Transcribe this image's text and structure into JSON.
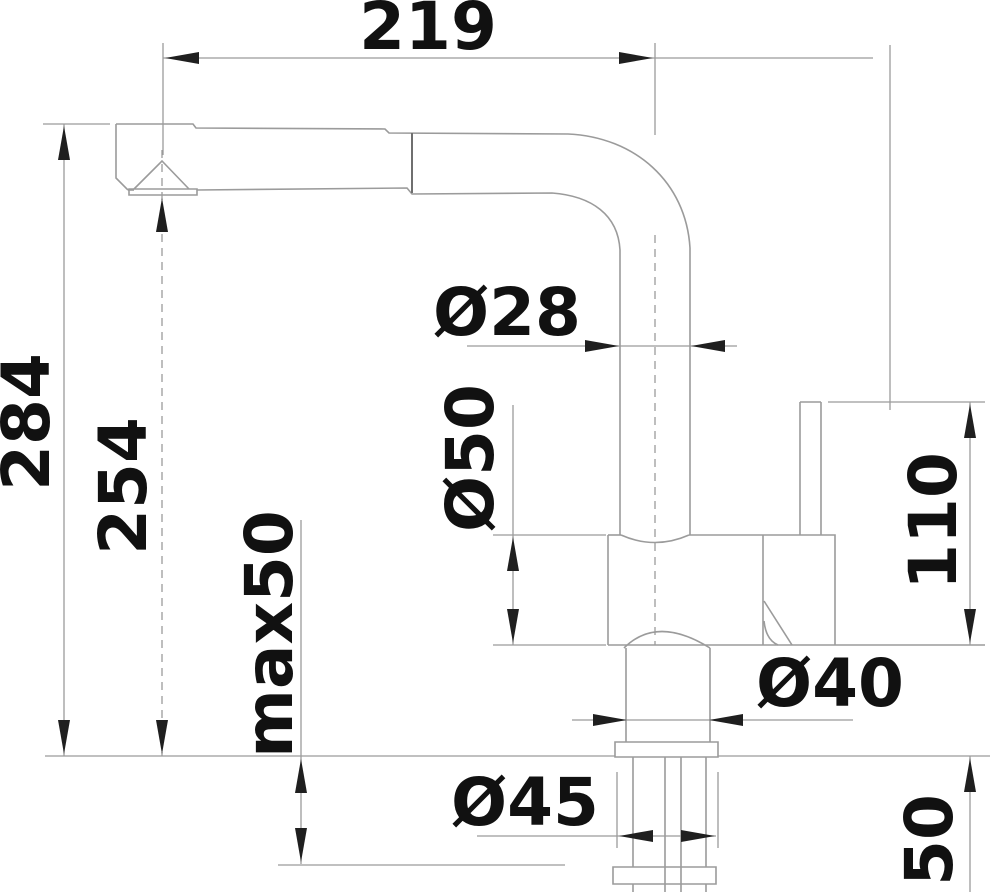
{
  "drawing": {
    "description": "faucet dimensional drawing",
    "colors": {
      "line": "#9b9b9b",
      "arrow": "#1f1f1f",
      "text": "#111111",
      "background": "#ffffff"
    },
    "dimensions": [
      {
        "id": "spout-reach",
        "label": "219",
        "orientation": "horizontal"
      },
      {
        "id": "total-height",
        "label": "284",
        "orientation": "vertical"
      },
      {
        "id": "spout-height",
        "label": "254",
        "orientation": "vertical"
      },
      {
        "id": "max-mount-thickness",
        "label": "max50",
        "orientation": "vertical"
      },
      {
        "id": "spout-tube-diameter",
        "label": "Ø28",
        "orientation": "horizontal"
      },
      {
        "id": "body-diameter",
        "label": "Ø50",
        "orientation": "vertical"
      },
      {
        "id": "base-diameter",
        "label": "Ø40",
        "orientation": "horizontal"
      },
      {
        "id": "flange-diameter",
        "label": "Ø45",
        "orientation": "horizontal"
      },
      {
        "id": "lever-height",
        "label": "110",
        "orientation": "vertical"
      },
      {
        "id": "shank-length",
        "label": "50",
        "orientation": "vertical"
      }
    ]
  }
}
